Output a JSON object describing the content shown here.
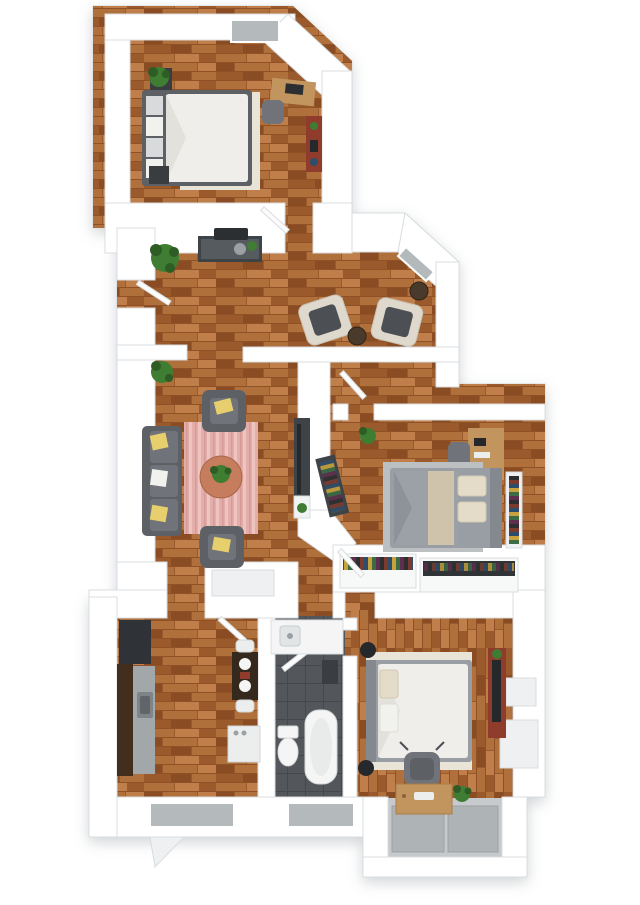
{
  "meta": {
    "label": "3D apartment floor plan, top-down view",
    "type": "3d-floor-plan",
    "canvas": {
      "width": 640,
      "height": 905
    }
  },
  "rooms": [
    {
      "id": "bedroom-top",
      "name": "bedroom",
      "furniture": [
        "double-bed",
        "area-rug",
        "nightstand",
        "nightstand",
        "potted-plant",
        "desk",
        "desk-chair",
        "storage-bench",
        "window"
      ]
    },
    {
      "id": "living-dining",
      "name": "living-dining-area",
      "furniture": [
        "console-table",
        "floor-plant",
        "floor-plant",
        "cream-armchair",
        "cream-armchair",
        "side-table",
        "side-table",
        "gray-sofa",
        "lounge-chair",
        "lounge-chair",
        "striped-rug",
        "round-coffee-table",
        "tv-console",
        "plant"
      ]
    },
    {
      "id": "bedroom-right",
      "name": "bedroom",
      "furniture": [
        "double-bed",
        "area-rug",
        "desk",
        "desk-chair",
        "wall-shelf",
        "bookshelf",
        "potted-plant",
        "wardrobe-closet",
        "wardrobe-closet"
      ]
    },
    {
      "id": "hallway",
      "name": "hallway",
      "furniture": [
        "door"
      ]
    },
    {
      "id": "kitchen",
      "name": "kitchen",
      "furniture": [
        "refrigerator",
        "cabinet-counter",
        "sink",
        "dining-table",
        "dining-chair",
        "dining-chair",
        "dishwasher",
        "window"
      ]
    },
    {
      "id": "bathroom",
      "name": "bathroom",
      "furniture": [
        "vanity-sink",
        "mirror",
        "toilet",
        "bathtub",
        "window"
      ]
    },
    {
      "id": "bedroom-bottom",
      "name": "bedroom",
      "furniture": [
        "double-bed",
        "area-rug",
        "speaker",
        "speaker",
        "tv-console",
        "window-ledge",
        "window-ledge"
      ]
    },
    {
      "id": "desk-nook",
      "name": "desk-nook",
      "furniture": [
        "desk",
        "office-chair",
        "potted-plant",
        "floor-mat",
        "floor-mat"
      ]
    }
  ],
  "palette": {
    "page_bg": "#ffffff",
    "wall": "#ffffff",
    "wall_edge": "#d8dcdf",
    "wall_shade": "#eef0f2",
    "slab_shadow": "#c9ced2",
    "wood_a": "#b0703c",
    "wood_b": "#9a5a2b",
    "wood_c": "#8a4c22",
    "wood_d": "#c07f4a",
    "wood_line": "#7c3f1b",
    "rug_pink": "#e3aeaa",
    "rug_pink_light": "#eec4c0",
    "rug_pink_dark": "#d79b97",
    "rug_cream": "#e9e4d8",
    "rug_gray": "#bcc0c2",
    "sofa_gray": "#5d6166",
    "sofa_gray_light": "#70747a",
    "pillow_yellow": "#e8cf6e",
    "pillow_white": "#f1f1ee",
    "armchair_cream": "#ded9cc",
    "armchair_cushion": "#4c5055",
    "table_terracotta": "#c57d5e",
    "wood_desk": "#c2955f",
    "console_dark": "#3e4347",
    "console_red": "#8f3c2c",
    "plant_green": "#3f7d33",
    "plant_dark": "#2d5c25",
    "cabinet_brown": "#432e1e",
    "counter_gray": "#a2a7aa",
    "sink_gray": "#7e8487",
    "appliance_white": "#eceeee",
    "tile_dark": "#53575b",
    "tile_line": "#45494d",
    "alcove_gray": "#c6cacc",
    "mat_gray": "#aeb3b6",
    "fixture_white": "#f4f5f4",
    "tv_black": "#26292c",
    "bed_frame_gray": "#989ea3",
    "blanket_gray": "#9ba1a6",
    "blanket_tan": "#cfc3ab",
    "headboard_gray": "#83898e",
    "duvet_white": "#efeeea",
    "window_gray": "#b4b9bc",
    "strip_1": "#7a3b2e",
    "strip_2": "#2e4d6b",
    "strip_3": "#c8a23c",
    "strip_4": "#3c6b44",
    "strip_5": "#5d2e4d",
    "strip_6": "#2e2e30"
  }
}
